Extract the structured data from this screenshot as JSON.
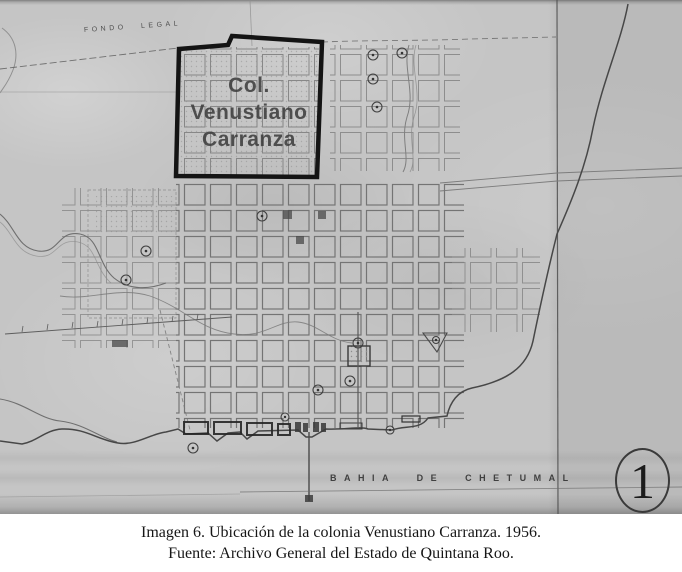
{
  "figure": {
    "map": {
      "fondo_legal_label": "FONDO LEGAL",
      "colonia_label": {
        "line1": "Col.",
        "line2": "Venustiano",
        "line3": "Carranza"
      },
      "bay_label": "BAHIA DE CHETUMAL",
      "sheet_number": "1"
    },
    "caption": {
      "line1": "Imagen 6. Ubicación de la colonia Venustiano Carranza. 1956.",
      "line2": "Fuente: Archivo General del Estado de Quintana Roo."
    },
    "colors": {
      "paper": "#c5c5c5",
      "boundary": "#141414",
      "label_gray": "#3e3e3e",
      "caption_text": "#161616",
      "page_background": "#ffffff"
    }
  }
}
